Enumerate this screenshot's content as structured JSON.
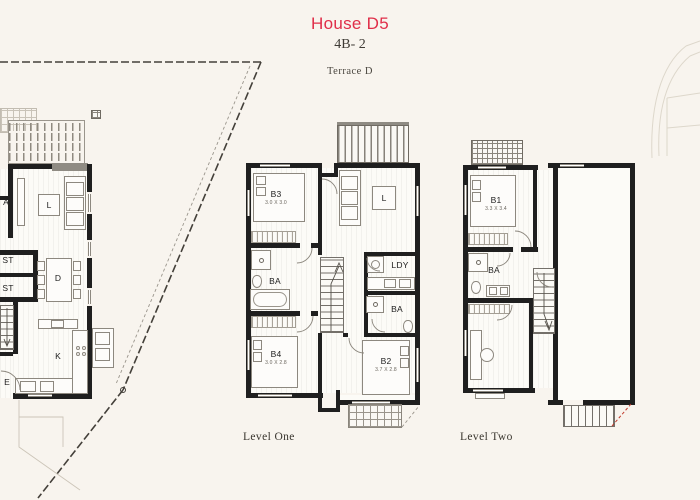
{
  "header": {
    "title": "House D5",
    "subtitle": "4B- 2",
    "plan_name": "Terrace D"
  },
  "colors": {
    "accent": "#e02e49",
    "walls": "#1f1f1f",
    "background": "#f8f4ee",
    "stair_red_dash": "#c0392b"
  },
  "site_plan": {
    "labels": {
      "bath": "A",
      "living": "L",
      "store_1": "ST",
      "store_2": "ST",
      "dining": "D",
      "kitchen": "K",
      "entry": "E"
    }
  },
  "level_one": {
    "caption": "Level One",
    "rooms": {
      "b3": {
        "label": "B3",
        "dim": "3.0 X 3.0"
      },
      "living": {
        "label": "L"
      },
      "laundry": {
        "label": "LDY"
      },
      "bath_main": {
        "label": "BA"
      },
      "bath_two": {
        "label": "BA"
      },
      "b4": {
        "label": "B4",
        "dim": "3.0 X 2.8"
      },
      "b2": {
        "label": "B2",
        "dim": "3.7 X 2.8"
      }
    }
  },
  "level_two": {
    "caption": "Level Two",
    "rooms": {
      "b1": {
        "label": "B1",
        "dim": "3.3 X 3.4"
      },
      "bath": {
        "label": "BA"
      }
    }
  }
}
